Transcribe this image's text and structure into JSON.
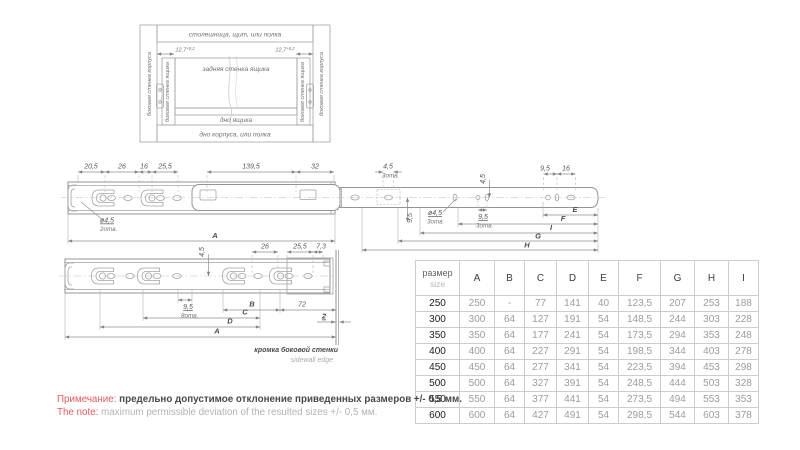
{
  "colors": {
    "accent_red": "#e25b5b",
    "line_gray": "#949494",
    "value_gray": "#9c9c9c"
  },
  "install": {
    "top": "столешница, щит, или полка",
    "bottom": "дно корпуса, или полка",
    "side_body": "боковая стенка корпуса",
    "side_drawer": "боковая стенка ящика",
    "back": "задняя стенка ящика",
    "drawer_bottom": "дно ящика",
    "gap_main": "12,7",
    "gap_tol": "+0,2"
  },
  "top_view": {
    "d20_5": "20,5",
    "d26": "26",
    "d16": "16",
    "d25_5": "25,5",
    "d139_5": "139,5",
    "d32": "32",
    "hole_a": "ø4,5",
    "hole_a_n": "2отв.",
    "d4_5": "4,5",
    "d4_5_n": "3отв.",
    "v4_5": "4,5",
    "v9_5": "9,5",
    "hole_b": "ø4,5",
    "hole_b_n": "3отв.",
    "d9_5": "9,5",
    "d9_5_n": "3отв.",
    "r9_5": "9,5",
    "r16": "16",
    "A": "A",
    "E": "E",
    "F": "F",
    "I": "I",
    "G": "G",
    "H": "H"
  },
  "front_view": {
    "d26": "26",
    "d25_5": "25,5",
    "d7_3": "7,3",
    "v4_5": "4,5",
    "d9_5": "9,5",
    "d9_5_n": "8отв.",
    "B": "B",
    "d72": "72",
    "C": "C",
    "D": "D",
    "A": "A",
    "d2": "2",
    "edge_ru": "кромка боковой стенки",
    "edge_en": "sidewall edge"
  },
  "table": {
    "size_ru": "размер",
    "size_en": "size",
    "cols": [
      "A",
      "B",
      "C",
      "D",
      "E",
      "F",
      "G",
      "H",
      "I"
    ],
    "rows": [
      {
        "size": "250",
        "v": [
          "250",
          "-",
          "77",
          "141",
          "40",
          "123,5",
          "207",
          "253",
          "188"
        ]
      },
      {
        "size": "300",
        "v": [
          "300",
          "64",
          "127",
          "191",
          "54",
          "148,5",
          "244",
          "303",
          "228"
        ]
      },
      {
        "size": "350",
        "v": [
          "350",
          "64",
          "177",
          "241",
          "54",
          "173,5",
          "294",
          "353",
          "248"
        ]
      },
      {
        "size": "400",
        "v": [
          "400",
          "64",
          "227",
          "291",
          "54",
          "198,5",
          "344",
          "403",
          "278"
        ]
      },
      {
        "size": "450",
        "v": [
          "450",
          "64",
          "277",
          "341",
          "54",
          "223,5",
          "394",
          "453",
          "298"
        ]
      },
      {
        "size": "500",
        "v": [
          "500",
          "64",
          "327",
          "391",
          "54",
          "248,5",
          "444",
          "503",
          "328"
        ]
      },
      {
        "size": "550",
        "v": [
          "550",
          "64",
          "377",
          "441",
          "54",
          "273,5",
          "494",
          "553",
          "353"
        ]
      },
      {
        "size": "600",
        "v": [
          "600",
          "64",
          "427",
          "491",
          "54",
          "298,5",
          "544",
          "603",
          "378"
        ]
      }
    ]
  },
  "note": {
    "ru_label": "Примечание:",
    "ru_text": "предельно допустимое отклонение приведенных размеров +/- 0,5 мм.",
    "en_label": "The note:",
    "en_text": "maximum permissible deviation of the resulted sizes +/- 0,5 мм."
  }
}
